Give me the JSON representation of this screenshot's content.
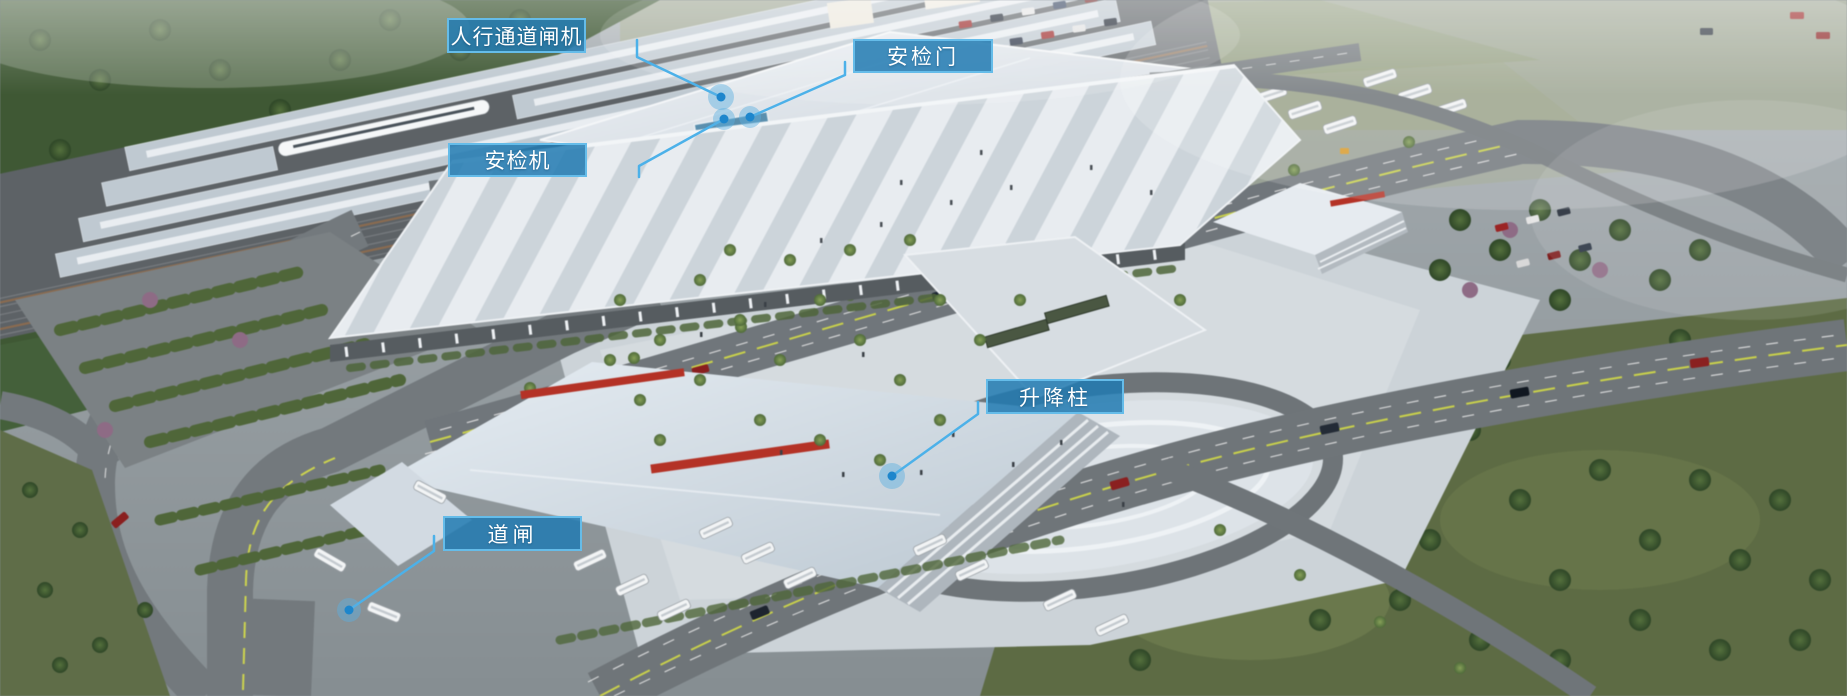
{
  "callouts": [
    {
      "id": "pedestrian-turnstile",
      "label": "人行通道闸机"
    },
    {
      "id": "security-door",
      "label": "安检门"
    },
    {
      "id": "security-scanner",
      "label": "安检机"
    },
    {
      "id": "lifting-bollard",
      "label": "升降柱"
    },
    {
      "id": "road-barrier-gate",
      "label": "道闸"
    }
  ],
  "colors": {
    "callout_fill": "rgba(33,122,178,0.85)",
    "callout_border": "#65bce9",
    "callout_text": "#ffffff",
    "leader_line": "#4cb1e9",
    "marker_dot": "#1d86cc",
    "marker_halo": "rgba(90,175,225,0.45)"
  }
}
